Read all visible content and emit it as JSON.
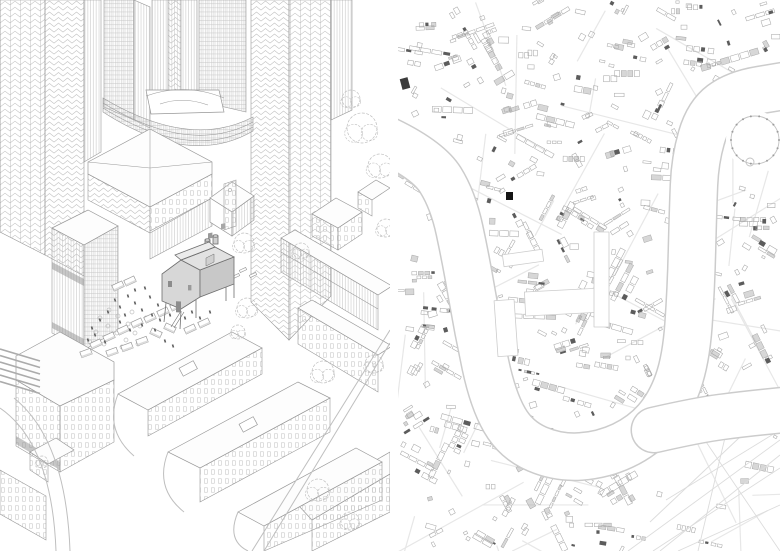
{
  "sheet": {
    "width": 780,
    "height": 551,
    "gutter": 8,
    "text_content": "none"
  },
  "theme": {
    "paper": "#ffffff",
    "line": "#989898",
    "line-light": "#bfbfbf",
    "line-dark": "#6e6e6e",
    "shade": "#8f8f8f",
    "house-wall": "#d7d7d7",
    "house-wall-dark": "#c8c8c8",
    "house-roof": "#e2e2e2",
    "marker": "#141414"
  },
  "left_panel": {
    "kind": "isometric-line-drawing",
    "trees": [
      [
        362,
        128,
        15
      ],
      [
        380,
        166,
        12
      ],
      [
        351,
        99,
        9
      ],
      [
        244,
        243,
        10
      ],
      [
        247,
        308,
        10
      ],
      [
        323,
        372,
        11
      ],
      [
        374,
        364,
        9
      ],
      [
        318,
        490,
        11
      ],
      [
        350,
        521,
        9
      ],
      [
        42,
        462,
        6
      ],
      [
        238,
        332,
        7
      ],
      [
        301,
        251,
        8
      ],
      [
        386,
        228,
        9
      ]
    ],
    "bushes": [
      [
        100,
        318
      ],
      [
        108,
        326
      ],
      [
        117,
        333
      ],
      [
        126,
        340
      ],
      [
        135,
        333
      ],
      [
        128,
        324
      ],
      [
        118,
        316
      ],
      [
        109,
        310
      ],
      [
        96,
        332
      ],
      [
        140,
        326
      ],
      [
        146,
        318
      ],
      [
        132,
        312
      ],
      [
        90,
        342
      ],
      [
        104,
        344
      ],
      [
        122,
        347
      ],
      [
        138,
        344
      ]
    ],
    "people": [
      [
        115,
        300
      ],
      [
        120,
        307
      ],
      [
        128,
        296
      ],
      [
        135,
        303
      ],
      [
        142,
        310
      ],
      [
        150,
        297
      ],
      [
        158,
        305
      ],
      [
        108,
        312
      ],
      [
        100,
        320
      ],
      [
        92,
        328
      ],
      [
        135,
        290
      ],
      [
        145,
        288
      ],
      [
        125,
        315
      ],
      [
        152,
        315
      ],
      [
        160,
        320
      ],
      [
        170,
        315
      ],
      [
        178,
        308
      ],
      [
        185,
        318
      ],
      [
        192,
        312
      ],
      [
        200,
        318
      ],
      [
        210,
        312
      ],
      [
        120,
        322
      ],
      [
        130,
        330
      ],
      [
        142,
        325
      ],
      [
        155,
        330
      ],
      [
        95,
        335
      ],
      [
        105,
        342
      ],
      [
        88,
        340
      ],
      [
        165,
        341
      ],
      [
        173,
        346
      ]
    ],
    "stalls": [
      [
        150,
        318,
        -25
      ],
      [
        163,
        312,
        -25
      ],
      [
        176,
        306,
        -25
      ],
      [
        137,
        323,
        -25
      ],
      [
        123,
        330,
        -25
      ],
      [
        109,
        337,
        -25
      ],
      [
        96,
        344,
        -25
      ],
      [
        112,
        352,
        -20
      ],
      [
        127,
        347,
        -20
      ],
      [
        142,
        341,
        -20
      ],
      [
        86,
        353,
        -20
      ],
      [
        190,
        329,
        -25
      ],
      [
        204,
        323,
        -25
      ],
      [
        156,
        333,
        25
      ],
      [
        170,
        328,
        25
      ],
      [
        118,
        286,
        -25
      ],
      [
        130,
        281,
        -25
      ]
    ],
    "benches": [
      [
        243,
        270
      ],
      [
        253,
        275
      ],
      [
        236,
        276
      ]
    ],
    "birds": [
      [
        222,
        261
      ],
      [
        231,
        263
      ],
      [
        223,
        268
      ],
      [
        232,
        270
      ],
      [
        226,
        275
      ]
    ]
  },
  "map": {
    "kind": "figure-ground-city-map",
    "seed": 20,
    "building_count": 540,
    "street_count": 46,
    "colors": {
      "stroke": "#a9a9a9",
      "fill_mid": "#9a9a9a",
      "fill_dark": "#5c5c5c",
      "street": "#e7e7e7",
      "bank": "#cccccc",
      "river": "#ffffff",
      "park": "#dcdcdc",
      "dome": "#c2c2c2"
    },
    "river": {
      "width": 46,
      "points": [
        [
          -12,
          140
        ],
        [
          30,
          160
        ],
        [
          55,
          200
        ],
        [
          68,
          260
        ],
        [
          80,
          330
        ],
        [
          95,
          400
        ],
        [
          118,
          440
        ],
        [
          160,
          458
        ],
        [
          205,
          455
        ],
        [
          245,
          436
        ],
        [
          272,
          405
        ],
        [
          288,
          360
        ],
        [
          293,
          290
        ],
        [
          295,
          210
        ],
        [
          297,
          160
        ],
        [
          310,
          115
        ],
        [
          338,
          94
        ],
        [
          386,
          86
        ]
      ]
    },
    "branch": {
      "width": 44,
      "points": [
        [
          256,
          430
        ],
        [
          300,
          420
        ],
        [
          346,
          414
        ],
        [
          386,
          410
        ]
      ]
    },
    "docks": [
      [
        127,
        290,
        78,
        24,
        -3
      ],
      [
        196,
        232,
        15,
        95,
        0
      ],
      [
        105,
        252,
        40,
        12,
        -8
      ],
      [
        98,
        300,
        20,
        56,
        -4
      ]
    ],
    "dome": {
      "cx": 357,
      "cy": 140,
      "r": 24,
      "dots": 18
    },
    "park": {
      "x_min": 266,
      "y_min": 428,
      "lines": [
        [
          230,
          551,
          382,
          440
        ],
        [
          255,
          551,
          382,
          468
        ],
        [
          280,
          551,
          382,
          505
        ],
        [
          382,
          430,
          268,
          500
        ],
        [
          300,
          430,
          382,
          551
        ],
        [
          330,
          425,
          300,
          551
        ],
        [
          360,
          420,
          252,
          522
        ],
        [
          382,
          455,
          262,
          551
        ]
      ]
    },
    "marker": {
      "x": 108,
      "y": 192,
      "w": 7,
      "h": 8
    },
    "dark_block": {
      "x": 3,
      "y": 78,
      "w": 8,
      "h": 11
    }
  }
}
